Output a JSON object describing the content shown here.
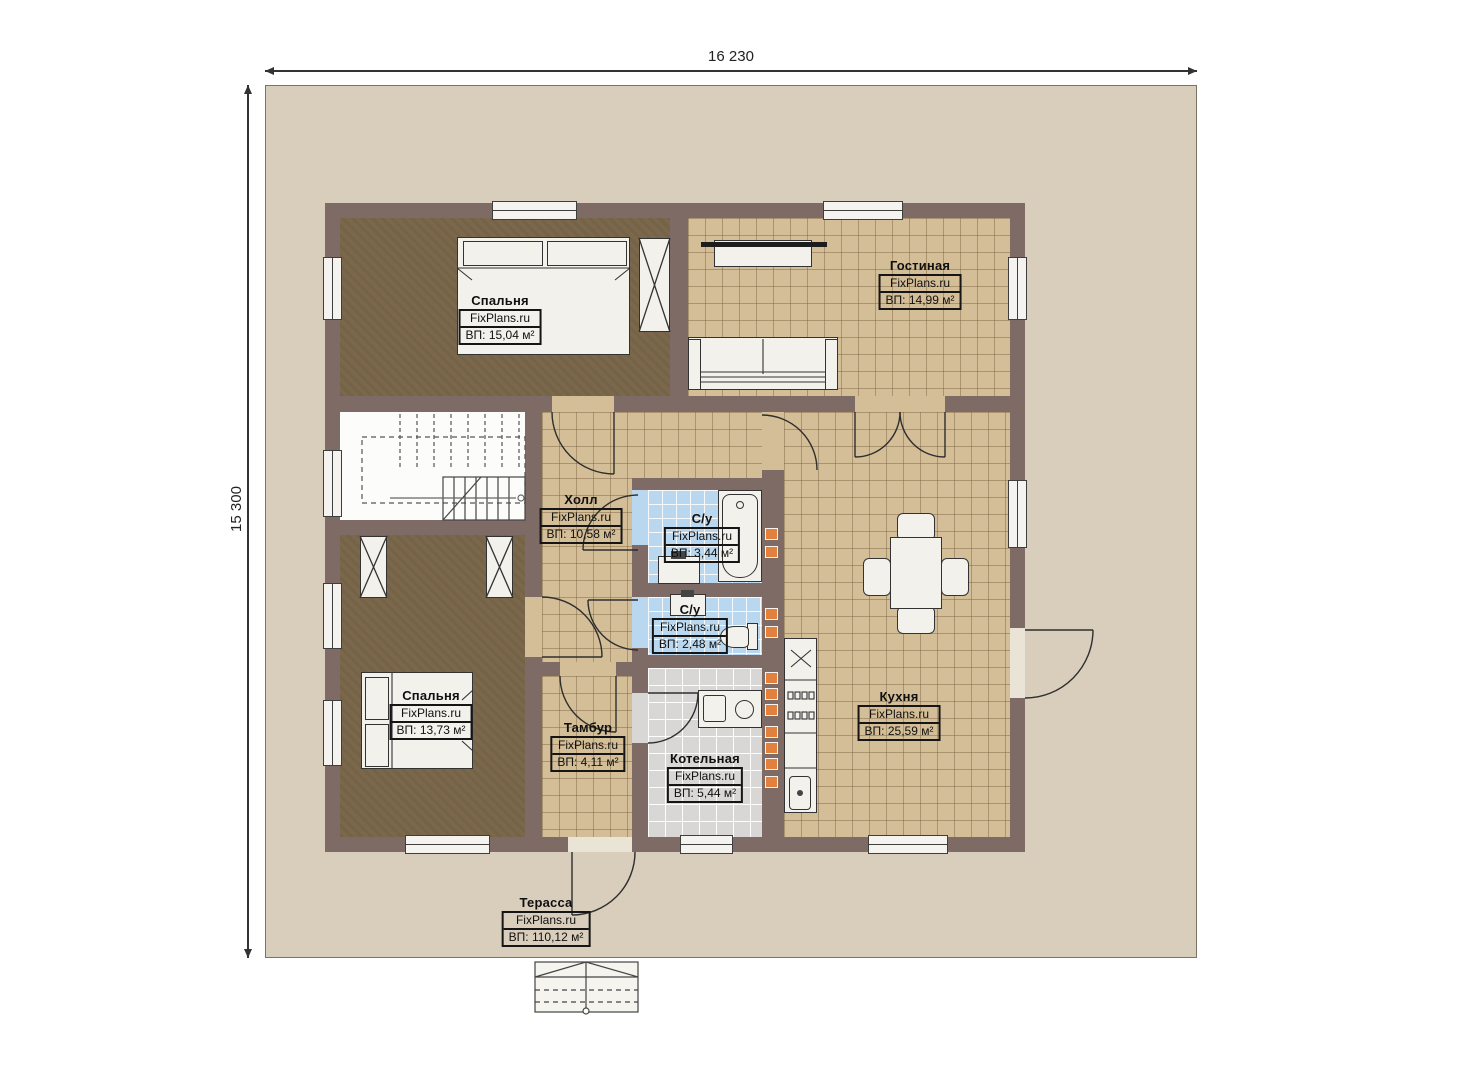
{
  "dimensions": {
    "horizontal": "16 230",
    "vertical": "15 300"
  },
  "watermark": "FixPlans.ru",
  "rooms": [
    {
      "id": "bedroom-top",
      "name": "Спальня",
      "area": "ВП: 15,04 м²"
    },
    {
      "id": "living-room",
      "name": "Гостиная",
      "area": "ВП: 14,99 м²"
    },
    {
      "id": "hall",
      "name": "Холл",
      "area": "ВП: 10,58 м²"
    },
    {
      "id": "bathroom-large",
      "name": "С/у",
      "area": "ВП: 3,44 м²"
    },
    {
      "id": "bathroom-small",
      "name": "С/у",
      "area": "ВП: 2,48 м²"
    },
    {
      "id": "bedroom-bottom",
      "name": "Спальня",
      "area": "ВП: 13,73 м²"
    },
    {
      "id": "vestibule",
      "name": "Тамбур",
      "area": "ВП: 4,11 м²"
    },
    {
      "id": "boiler-room",
      "name": "Котельная",
      "area": "ВП: 5,44 м²"
    },
    {
      "id": "kitchen",
      "name": "Кухня",
      "area": "ВП: 25,59 м²"
    },
    {
      "id": "terrace",
      "name": "Терасса",
      "area": "ВП: 110,12 м²"
    }
  ],
  "colors": {
    "wall": "#7f6b66",
    "terrace_floor": "#d9cdbb",
    "tile_floor": "#d4be97",
    "bathroom_tile": "#b9d7ee",
    "boiler_tile": "#d8d7d5",
    "bedroom_floor": "#7b684c",
    "vent_orange": "#e2813d"
  }
}
